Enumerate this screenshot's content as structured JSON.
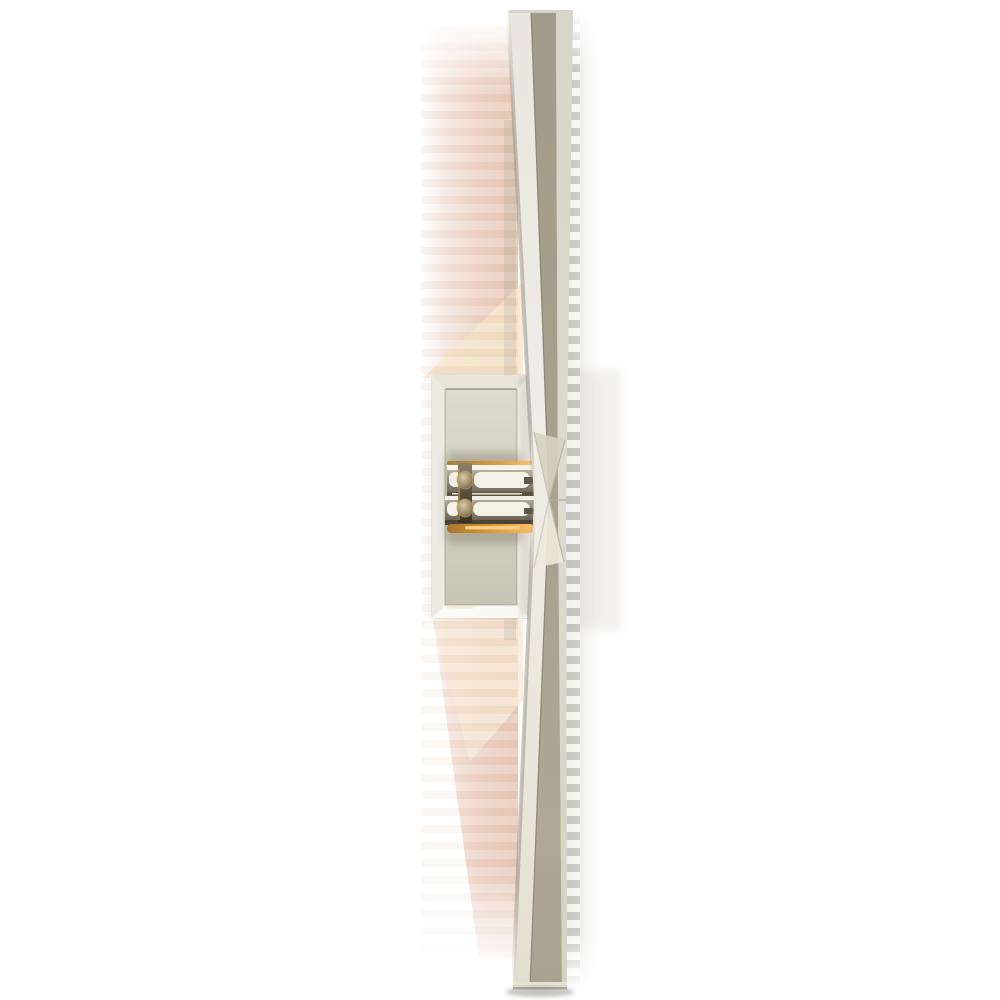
{
  "image": {
    "type": "product-photograph",
    "subject": "tall linear wall sconce light fixture, polished nickel finish with brass joint accents, mounted on rectangular backplate, lit with warm glow",
    "background": "#ffffff"
  },
  "palette": {
    "canvas-bg": "#ffffff",
    "nickel-white-face": "#efece5",
    "nickel-taupe-face": "#a7a18e",
    "nickel-crease": "#7f786a",
    "nickel-edge-strip": "#dad6c9",
    "plate-frame": "#f0eee7",
    "plate-panel": "#d3d1c2",
    "plate-bevel-highlight": "#fafaf4",
    "brass-deep": "#a9742a",
    "brass-bright": "#f4b259",
    "brass-glow-core": "#ffd489",
    "arm-metal-dark": "#6d6757",
    "arm-metal-mid": "#968f7d",
    "glow-pink": "#eccfc0",
    "glow-cream": "#f7e3cb",
    "shadow-grey": "#98958f"
  },
  "parts": {
    "blade_upper": "upper tapered blade",
    "blade_lower": "lower tapered blade",
    "center_pinch": "x-facet meeting point of blades",
    "backplate": "rectangular beveled wall backplate",
    "arms": "double stacked mounting arms with brass glints",
    "glow": "warm pink banded light glow (left side)",
    "cast_shadow": "soft grey banded shadow (right side)"
  }
}
